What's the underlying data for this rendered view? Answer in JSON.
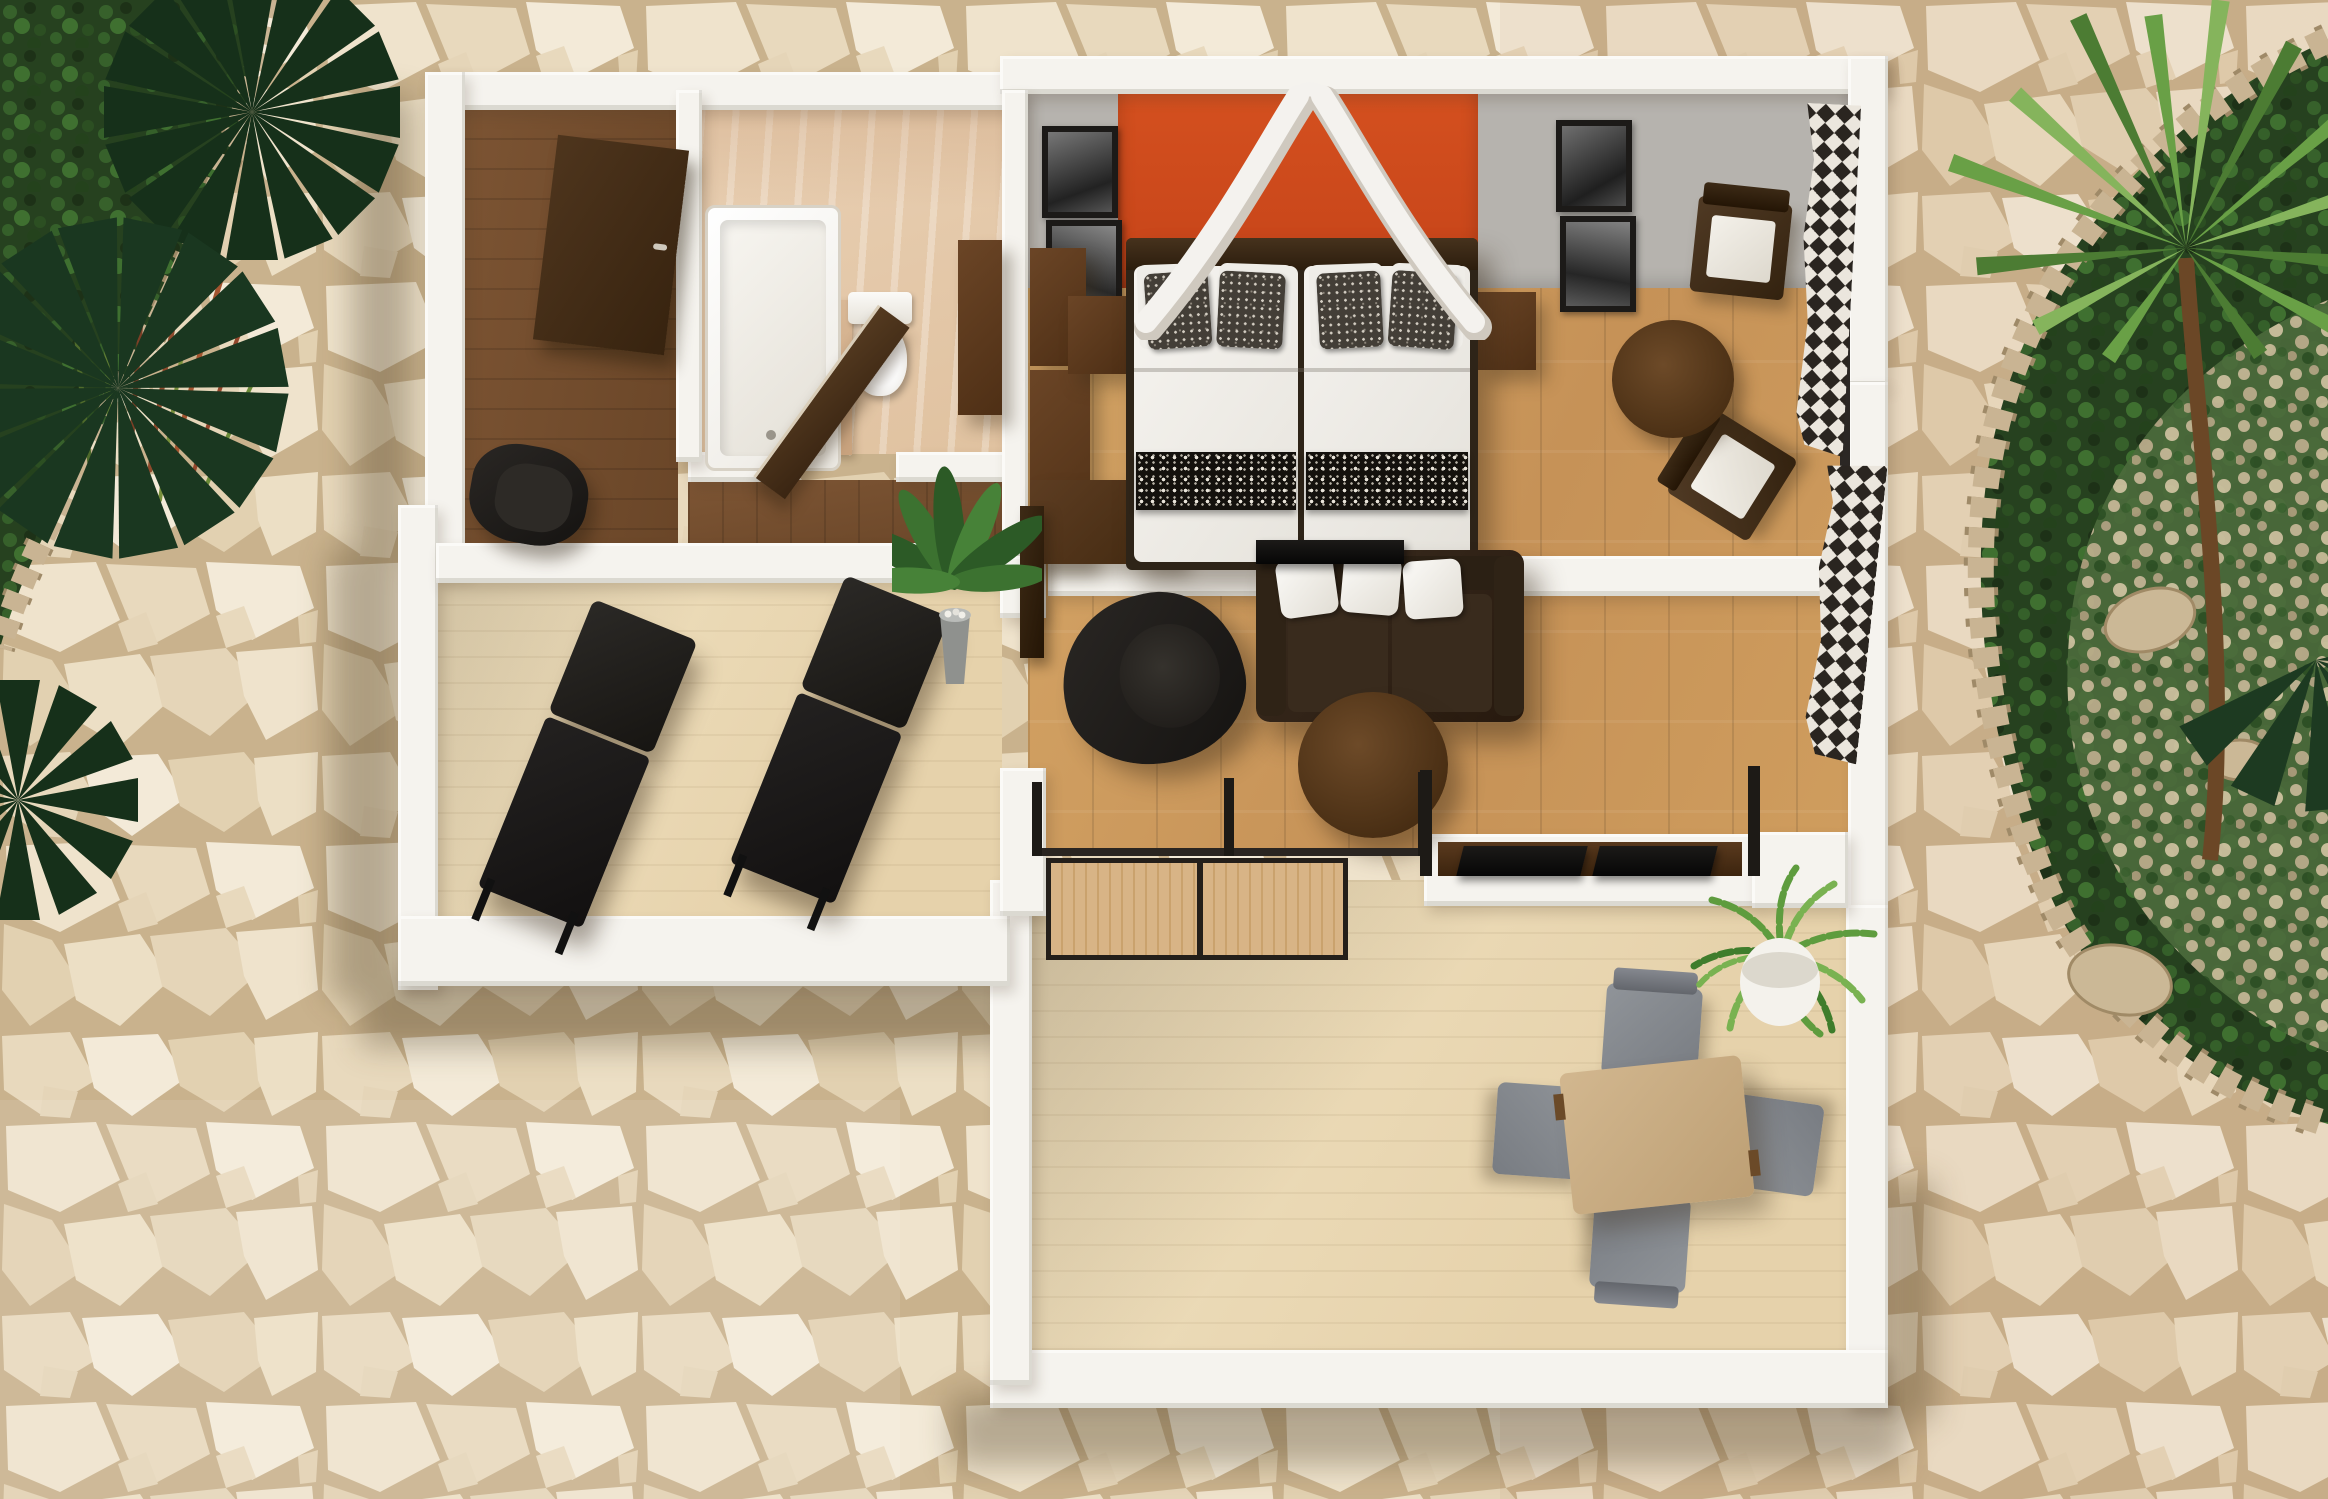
{
  "meta": {
    "kind": "3d-floor-plan-render",
    "view": "top-down isometric rendering of a hotel suite / apartment",
    "canvas": {
      "width": 2328,
      "height": 1499
    },
    "visible_text": "none"
  },
  "palette": {
    "stone-grout": "#c9b28d",
    "stone-1": "#efe3cc",
    "stone-2": "#e8d9bd",
    "stone-3": "#f3ead8",
    "stone-4": "#e2d1b1",
    "stone-5": "#ecdfc5",
    "stone-6": "#e5d5b8",
    "wall-top": "#f5f3ee",
    "gray-wall": "#b6b3ae",
    "accent-orange": "#cd4a20",
    "walnut": "#6e482a",
    "walnut-dark": "#4b3018",
    "travertine": "#e5c9ab",
    "oak-floor": "#cf9d5e",
    "pale-wood": "#ecdcba",
    "sofa-brown": "#37291d",
    "charcoal": "#1d1b18",
    "cushion-white": "#f2f0ec",
    "curtain-dark": "#2a2520",
    "garden-green": "#26411f",
    "leaf-green": "#5e9c3e",
    "pot-gray": "#8f918e",
    "dining-tan": "#c9ae85",
    "chair-gray": "#85888d",
    "rock-border": "#c9b493"
  },
  "scene": {
    "outdoor": {
      "ground": "beige-flagstone-paving",
      "planting_beds": [
        {
          "name": "garden-bed-top-left",
          "features": [
            "fan-palm",
            "red-ornamental-grass",
            "shrubs",
            "rock-border"
          ]
        },
        {
          "name": "garden-bed-right",
          "features": [
            "yucca-palm",
            "fan-palm-fronds",
            "shrubs",
            "gravel",
            "boulders",
            "rock-border"
          ]
        }
      ]
    },
    "rooms": [
      {
        "name": "entry-hall",
        "floor": "dark-walnut-plank",
        "furniture": [
          "entry-door-open",
          "black-armchair"
        ]
      },
      {
        "name": "bathroom",
        "floor": "travertine-tile",
        "furniture": [
          "walk-in-bathtub",
          "toilet",
          "bathroom-door-open",
          "walnut-vanity",
          "partition-stub-wall"
        ]
      },
      {
        "name": "bedroom",
        "floor": "oak-plank",
        "wall_features": [
          "orange-accent-panel",
          "white-canopy-drape",
          "four-framed-portraits",
          "checkered-window-curtains"
        ],
        "furniture": [
          "double-bed-two-mattresses",
          "dark-headboard",
          "patterned-pillows",
          "black-pattern-runners",
          "nightstand-left",
          "nightstand-right",
          "wardrobe-units",
          "flat-tv-on-foot-wall",
          "armchair-with-white-cushion-x2",
          "round-side-table"
        ]
      },
      {
        "name": "living-room",
        "floor": "oak-plank",
        "furniture": [
          "black-swivel-armchair",
          "brown-loveseat-sofa",
          "three-white-throw-pillows",
          "round-coffee-table",
          "media-console-with-two-tv-panels",
          "glass-sliding-door",
          "interior-door-leaf"
        ]
      },
      {
        "name": "side-terrace",
        "floor": "pale-wood-deck",
        "furniture": [
          "sun-lounger-x2",
          "potted-plant-gray-pot"
        ]
      },
      {
        "name": "lower-terrace",
        "floor": "pale-wood-deck",
        "furniture": [
          "square-dining-table",
          "gray-dining-chair-x4",
          "white-round-planter-palm",
          "wood-slat-sliding-screens"
        ]
      }
    ]
  }
}
